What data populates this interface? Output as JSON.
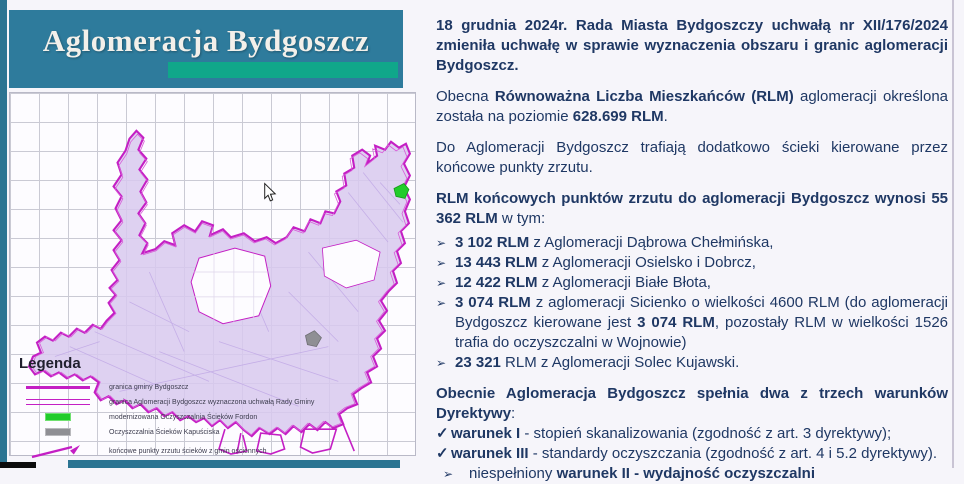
{
  "title": "Aglomeracja Bydgoszcz",
  "glyphs": {
    "bullet": "➢",
    "check": "✓"
  },
  "colors": {
    "teal_block": "#2E7B9C",
    "teal_strip": "#2B7492",
    "green_accent": "#10A78A",
    "magenta_boundary": "#C41FC4",
    "lavender_fill": "#D8C9EE",
    "navy_text": "#1F3864",
    "marker_green": "#22CC2B",
    "marker_gray": "#8F8F94"
  },
  "map": {
    "legend": {
      "title": "Legenda",
      "items": [
        {
          "symbol": "thick-line",
          "label": "granica gminy Bydgoszcz"
        },
        {
          "symbol": "double-line",
          "label": "granica Aglomeracji Bydgoszcz wyznaczona uchwałą Rady Gminy"
        },
        {
          "symbol": "green-rect",
          "label": "modernizowana Oczyszczalnia Ścieków Fordon"
        },
        {
          "symbol": "gray-rect",
          "label": "Oczyszczalnia Ścieków Kapuściska"
        },
        {
          "symbol": "arrow",
          "label": "końcowe punkty zrzutu ścieków z gmin ościennych"
        }
      ]
    }
  },
  "content": {
    "paragraphs": [
      {
        "segments": [
          {
            "t": "18 grudnia 2024r. Rada Miasta Bydgoszczy uchwałą nr XII/176/2024 zmieniła uchwałę w sprawie wyznaczenia obszaru i granic aglomeracji Bydgoszcz.",
            "b": true
          }
        ]
      },
      {
        "segments": [
          {
            "t": "Obecna ",
            "b": false
          },
          {
            "t": "Równoważna Liczba Mieszkańców (RLM)",
            "b": true
          },
          {
            "t": " aglomeracji określona została na poziomie ",
            "b": false
          },
          {
            "t": "628.699 RLM",
            "b": true
          },
          {
            "t": ".",
            "b": false
          }
        ]
      },
      {
        "segments": [
          {
            "t": "Do Aglomeracji Bydgoszcz trafiają dodatkowo ścieki kierowane przez końcowe punkty zrzutu.",
            "b": false
          }
        ]
      },
      {
        "segments": [
          {
            "t": "RLM końcowych punktów zrzutu do aglomeracji Bydgoszcz wynosi 55 362 RLM",
            "b": true
          },
          {
            "t": " w tym:",
            "b": false
          }
        ]
      }
    ],
    "bullets": [
      {
        "segments": [
          {
            "t": "3 102 RLM",
            "b": true
          },
          {
            "t": " z Aglomeracji Dąbrowa Chełmińska,",
            "b": false
          }
        ]
      },
      {
        "segments": [
          {
            "t": "13 443 RLM",
            "b": true
          },
          {
            "t": " z Aglomeracji Osielsko i Dobrcz,",
            "b": false
          }
        ]
      },
      {
        "segments": [
          {
            "t": "12 422 RLM",
            "b": true
          },
          {
            "t": " z Aglomeracji Białe Błota,",
            "b": false
          }
        ]
      },
      {
        "segments": [
          {
            "t": "3 074 RLM",
            "b": true
          },
          {
            "t": " z aglomeracji Sicienko o wielkości 4600 RLM (do aglomeracji Bydgoszcz kierowane jest ",
            "b": false
          },
          {
            "t": "3 074 RLM",
            "b": true
          },
          {
            "t": ", pozostały RLM w wielkości 1526 trafia do oczyszczalni w Wojnowie)",
            "b": false
          }
        ]
      },
      {
        "segments": [
          {
            "t": "23 321",
            "b": true
          },
          {
            "t": " RLM z Aglomeracji Solec Kujawski.",
            "b": false
          }
        ]
      }
    ],
    "conditions": {
      "header_segments": [
        {
          "t": "Obecnie Aglomeracja Bydgoszcz spełnia dwa z trzech warunków Dyrektywy",
          "b": true
        },
        {
          "t": ":",
          "b": false
        }
      ],
      "items": [
        {
          "glyph": "check",
          "segments": [
            {
              "t": "warunek I",
              "b": true
            },
            {
              "t": " - stopień skanalizowania (zgodność z art. 3 dyrektywy);",
              "b": false
            }
          ]
        },
        {
          "glyph": "check",
          "segments": [
            {
              "t": "warunek III",
              "b": true
            },
            {
              "t": " - standardy oczyszczania (zgodność z art. 4 i 5.2 dyrektywy).",
              "b": false
            }
          ]
        },
        {
          "glyph": "bullet",
          "segments": [
            {
              "t": "niespełniony ",
              "b": false
            },
            {
              "t": "warunek II - wydajność oczyszczalni",
              "b": true
            }
          ]
        }
      ]
    }
  }
}
